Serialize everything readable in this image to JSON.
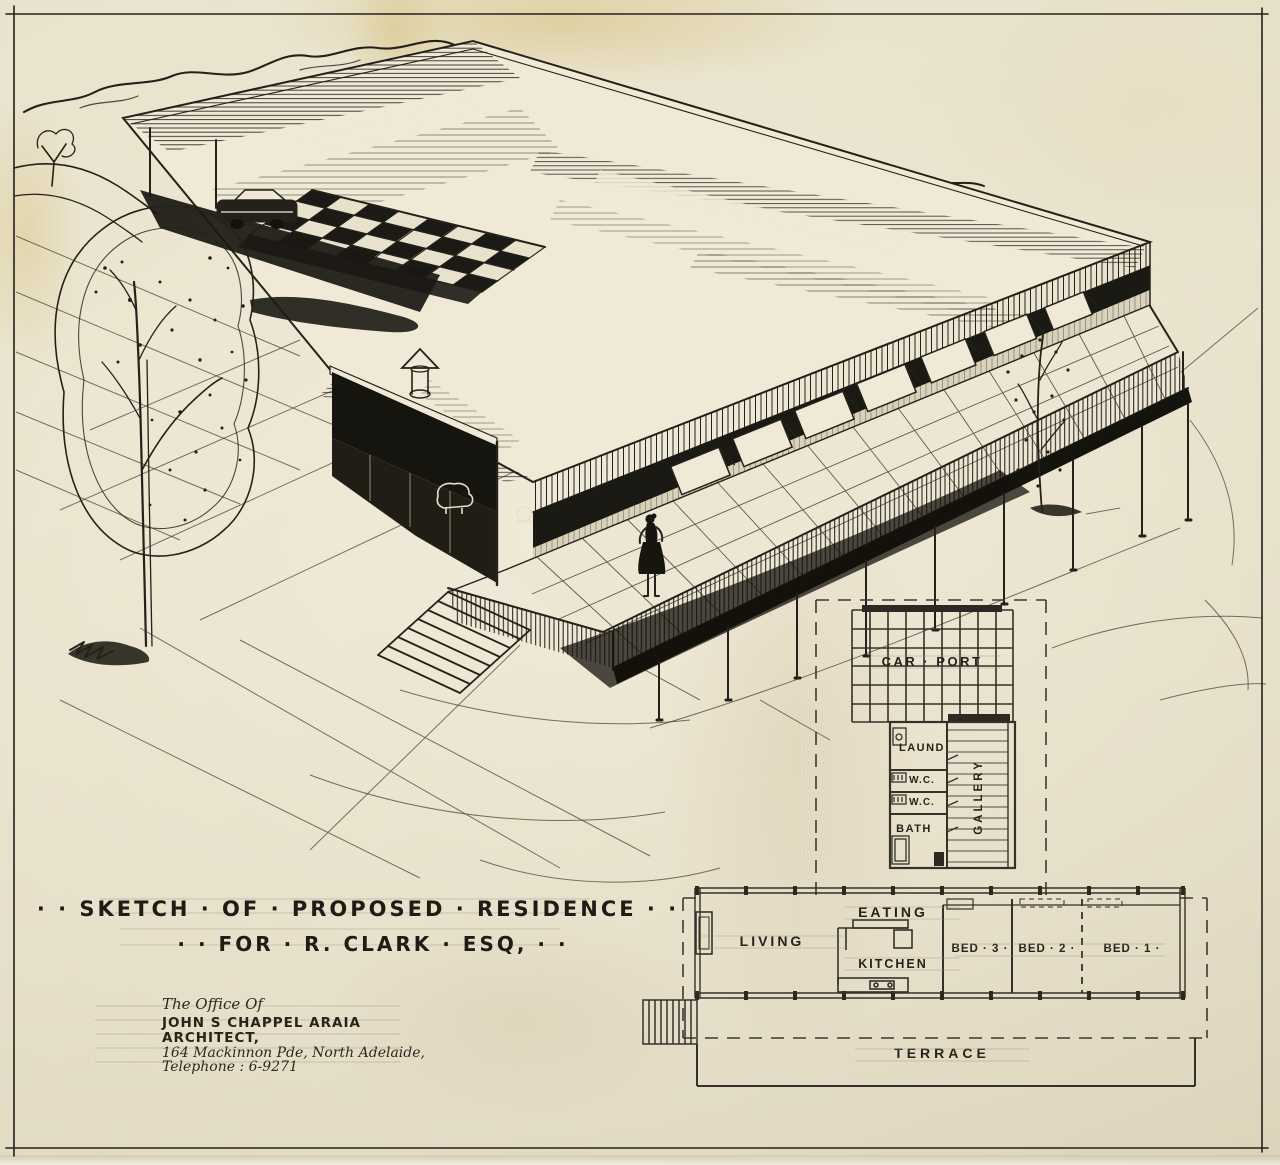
{
  "palette": {
    "paper": "#e9e2cd",
    "ink": "#24211a",
    "aged_stain": "#cdb273"
  },
  "title_block": {
    "line1": "· ·  SKETCH · OF · PROPOSED · RESIDENCE  · ·",
    "line2": "· ·  FOR  ·  R. CLARK · ESQ,  · ·"
  },
  "architect_block": {
    "office": "The Office Of",
    "name": "JOHN S CHAPPEL ARAIA",
    "role": "ARCHITECT,",
    "address": "164 Mackinnon Pde, North Adelaide,",
    "telephone": "Telephone : 6-9271"
  },
  "floor_plan": {
    "labels": {
      "carport": "CAR · PORT",
      "laundry": "LAUND",
      "wc_upper": "W.C.",
      "wc_lower": "W.C.",
      "bath": "BATH",
      "gallery": "GALLERY",
      "living": "LIVING",
      "eating": "EATING",
      "kitchen": "KITCHEN",
      "bed3": "BED · 3 ·",
      "bed2": "BED · 2 ·",
      "bed1": "BED · 1 ·",
      "terrace": "TERRACE"
    }
  }
}
